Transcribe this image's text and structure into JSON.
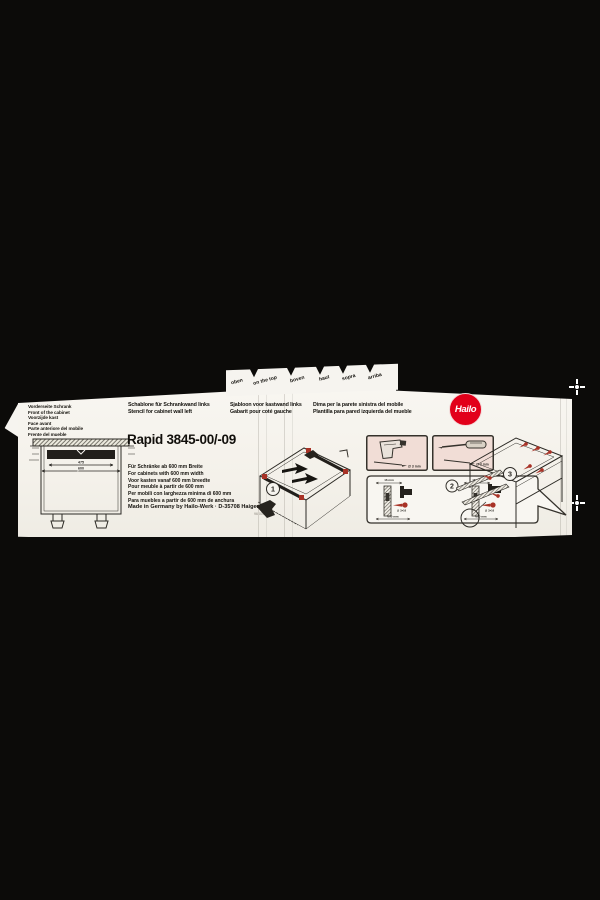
{
  "brand": {
    "logo_text": "Hailo",
    "logo_color": "#e2001a"
  },
  "top_strip": {
    "words": [
      "oben",
      "on the top",
      "boven",
      "haut",
      "sopra",
      "arriba"
    ]
  },
  "front_label_block": {
    "lines": [
      "Vorderseite Schrank",
      "Front of the cabinet",
      "Voorzijde kast",
      "Face avant",
      "Parte anteriore del mobile",
      "Frente del mueble"
    ]
  },
  "stencil_headers": {
    "col1": [
      "Schablone für Schrankwand links",
      "Stencil for cabinet wall left"
    ],
    "col2": [
      "Sjabloon voor kastwand links",
      "Gabarit pour coté gauche"
    ],
    "col3": [
      "Dima per la parete sinistra del mobile",
      "Plantilla para pared izquierda del mueble"
    ]
  },
  "product": {
    "title": "Rapid 3845-00/-09"
  },
  "width_requirements": [
    "Für Schränke ab 600 mm Breite",
    "For cabinets with 600 mm width",
    "Voor kasten vanaf 600 mm breedte",
    "Pour meuble à partir de 600 mm",
    "Per mobili con larghezza minima di 600 mm",
    "Para muebles a partir de 600 mm de anchura"
  ],
  "footer": {
    "made_in": "Made in Germany by Hailo-Werk · D-35708 Haiger",
    "part_no": "96 001 96"
  },
  "steps": {
    "one": "1",
    "two": "2",
    "three": "3"
  },
  "dims": {
    "inner_width": "475",
    "outer_width": "600",
    "rail_top": "16 mm",
    "rail_bottom": "600 mm",
    "screw": "∅ 3×16",
    "drill_bit": "∅ 3 mm"
  }
}
